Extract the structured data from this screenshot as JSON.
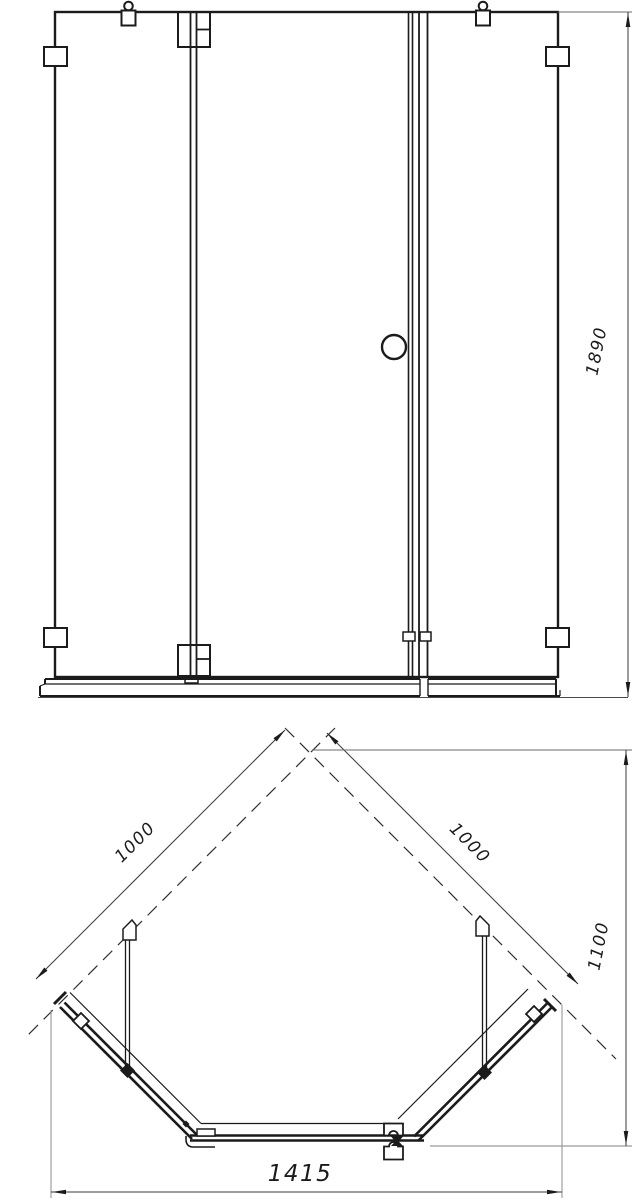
{
  "drawing": {
    "views": {
      "front_elevation": "front-elevation",
      "plan_view": "plan-view"
    },
    "dimensions": {
      "front_height": "1890",
      "left_side": "1000",
      "right_side": "1000",
      "depth": "1100",
      "width": "1415"
    },
    "colors": {
      "line": "#1b1b1b",
      "dim_line": "#3a3a3a",
      "extension_line": "#8c8c8c",
      "background": "#ffffff"
    }
  }
}
